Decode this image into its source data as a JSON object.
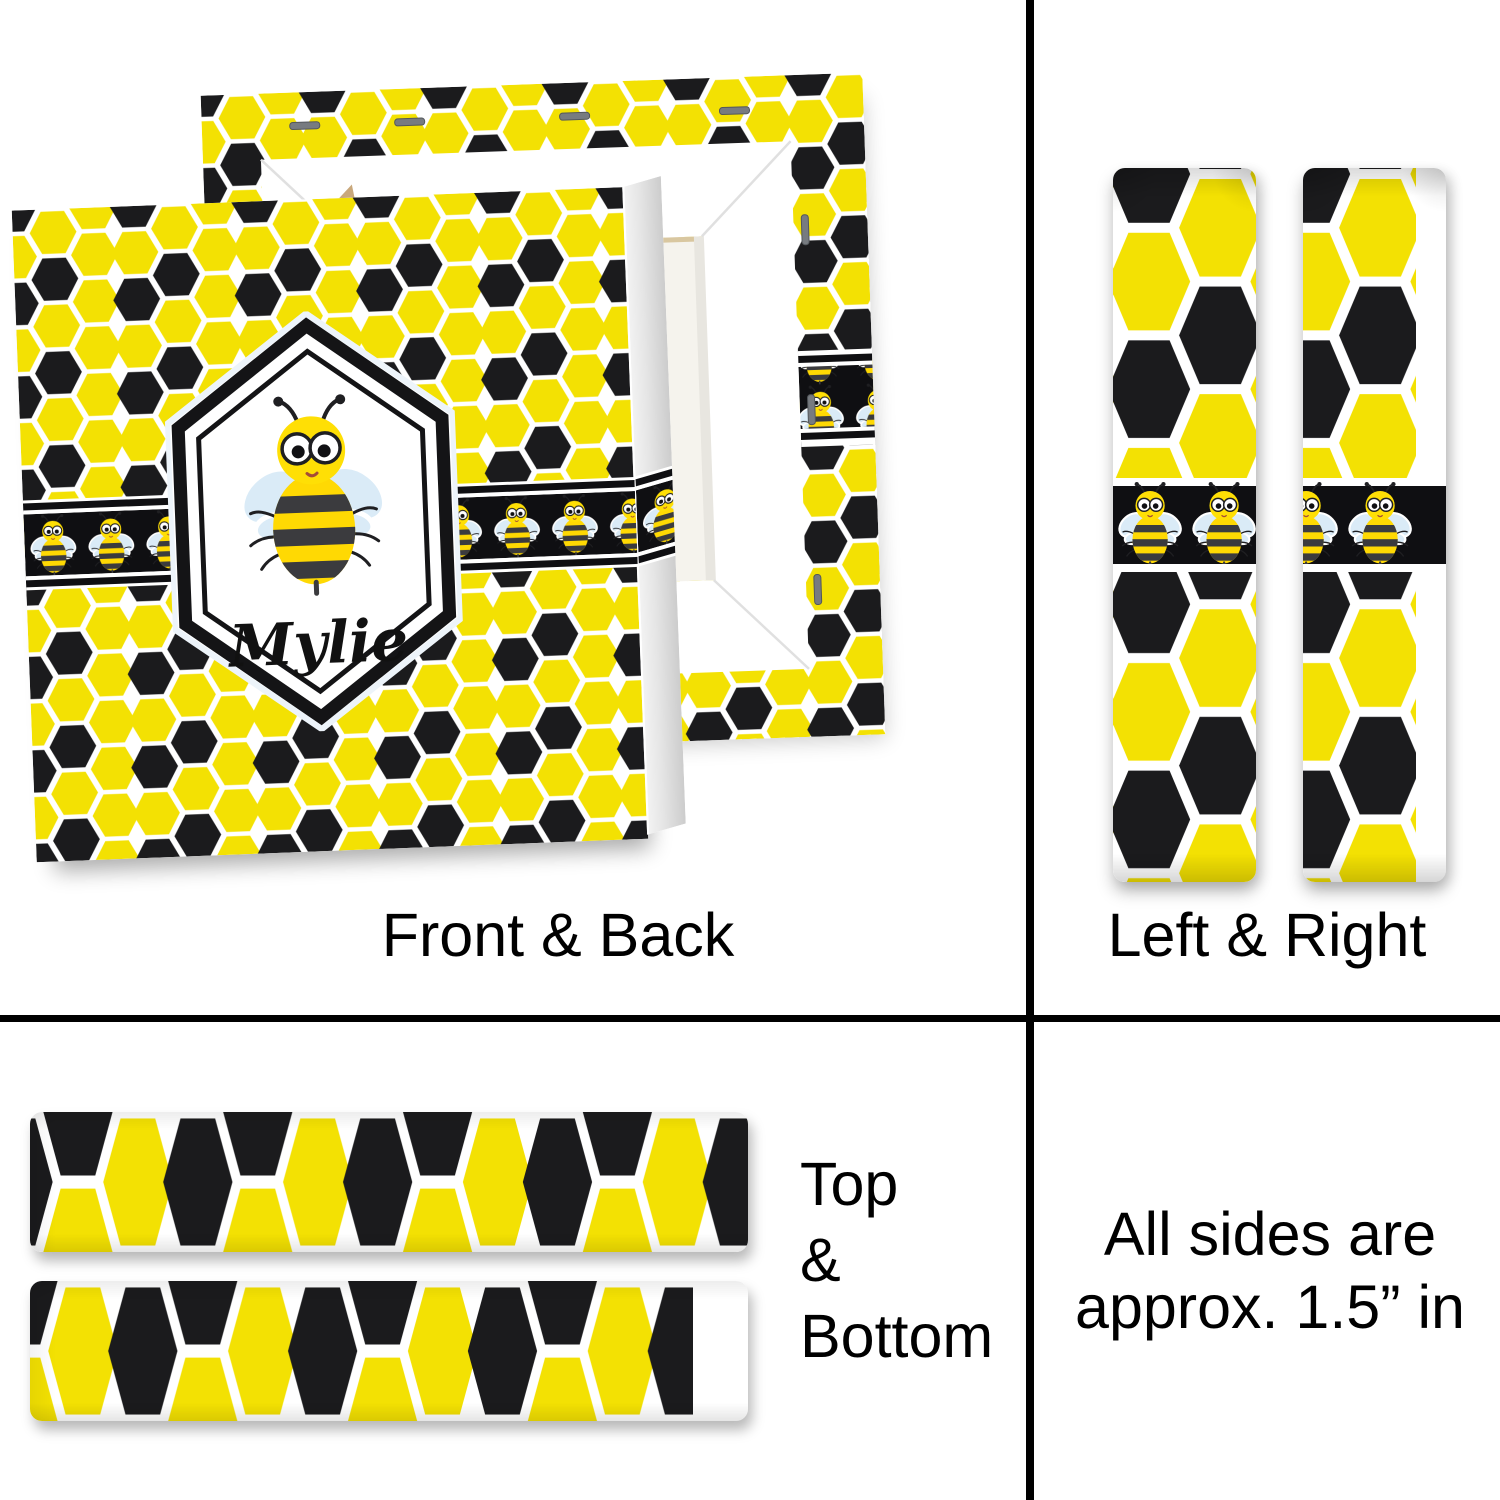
{
  "sections": {
    "front_back": {
      "label": "Front & Back"
    },
    "left_right": {
      "label": "Left & Right"
    },
    "top_bottom": {
      "lines": [
        "Top",
        "&",
        "Bottom"
      ]
    },
    "size_note": {
      "lines": [
        "All sides are",
        "approx. 1.5” in"
      ]
    }
  },
  "canvas": {
    "personalization_name": "Mylie",
    "design": "honeycomb-hexagon-with-bees"
  },
  "colors": {
    "pattern_yellow": "#F3E103",
    "pattern_black": "#1B1B1D",
    "band_black": "#0F0F12",
    "divider_black": "#000000",
    "bee_body_yellow": "#FFD903",
    "bee_head_yellow": "#FFDF05",
    "bee_stripe_dark": "#3B3B3E",
    "wing_blue": "#DAEBF7",
    "frame_white": "#FFFFFF",
    "canvas_back": "#F5F3ED",
    "wood_tan": "#C9A87C",
    "staple_gray": "#777B80"
  }
}
